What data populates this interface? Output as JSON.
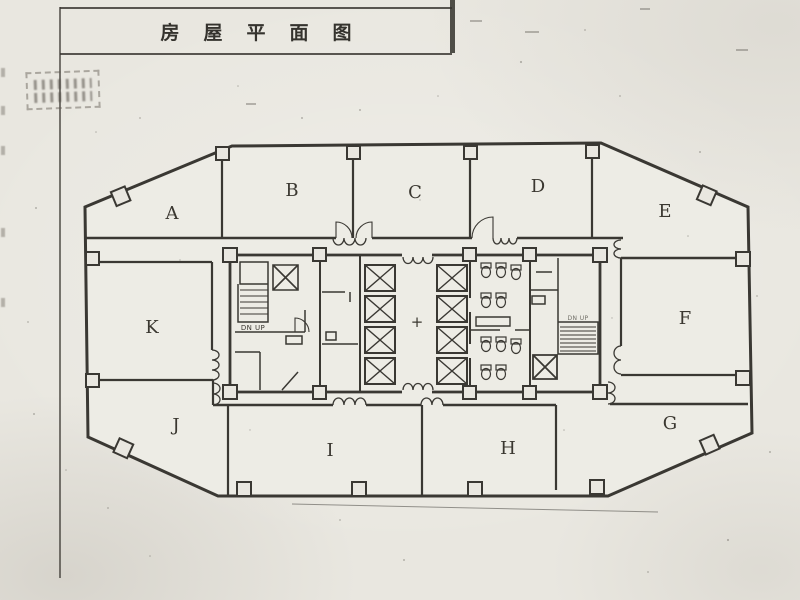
{
  "doc": {
    "title": "房屋平面图"
  },
  "plan": {
    "rooms": [
      {
        "label": "A"
      },
      {
        "label": "B"
      },
      {
        "label": "C"
      },
      {
        "label": "D"
      },
      {
        "label": "E"
      },
      {
        "label": "F"
      },
      {
        "label": "G"
      },
      {
        "label": "H"
      },
      {
        "label": "I"
      },
      {
        "label": "J"
      },
      {
        "label": "K"
      }
    ],
    "stair_left_label": "DN UP",
    "stair_right_label": "DN UP",
    "center_mark": "+"
  },
  "colors": {
    "ink": "#3a3833",
    "paper": "#e9e7e0"
  }
}
